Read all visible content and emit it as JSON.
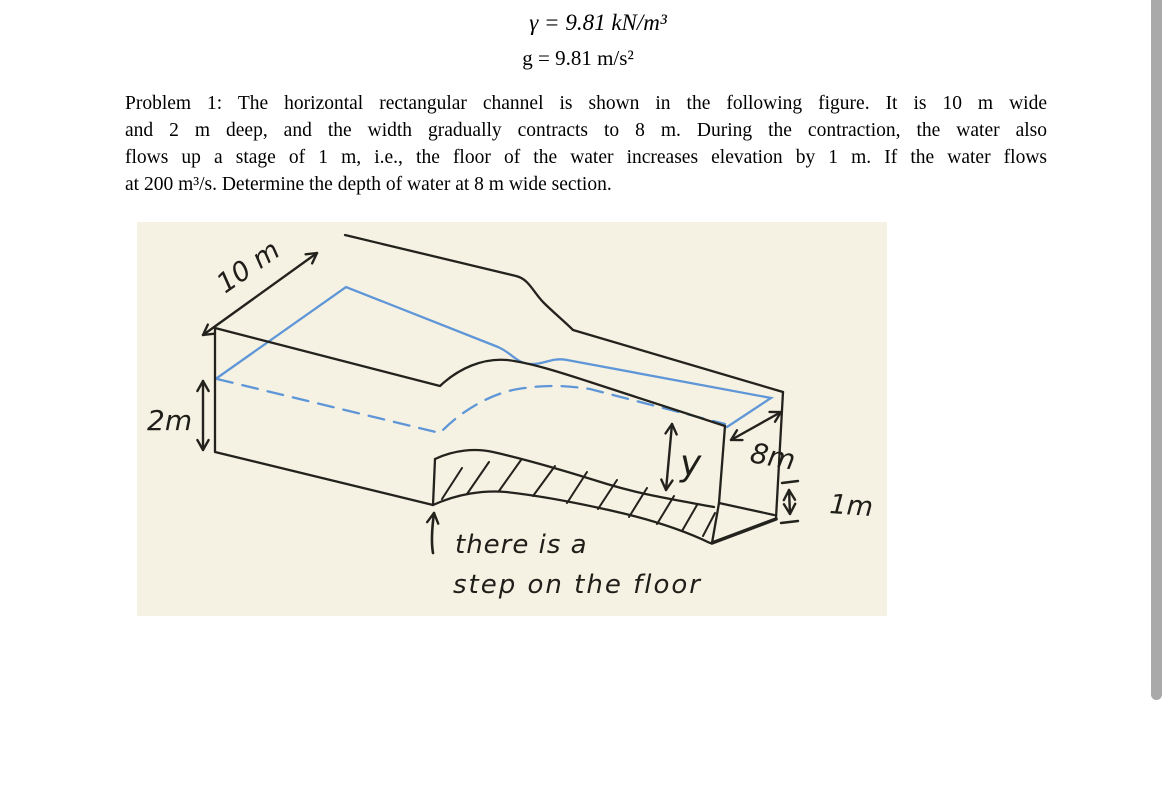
{
  "equations": {
    "line1": "γ = 9.81 kN/m³",
    "line2": "g = 9.81 m/s²"
  },
  "problem": {
    "lines": [
      "Problem 1: The horizontal rectangular channel is shown in the following figure. It is 10 m wide",
      "and 2 m deep, and the width gradually contracts to 8 m. During the contraction, the water also",
      "flows up a stage of 1 m, i.e., the floor of the water increases elevation by 1 m. If the water flows",
      "at 200 m³/s. Determine the depth of water at 8 m wide section."
    ]
  },
  "figure": {
    "labels": {
      "width_upstream": "10 m",
      "depth_upstream": "2m",
      "depth_downstream": "y",
      "width_downstream": "8m",
      "step_height": "1m",
      "note_line1": "there is a",
      "note_line2": "step on the floor"
    },
    "colors": {
      "background": "#f5f2e3",
      "ink": "#23221d",
      "water_blue": "#5f96d7"
    }
  },
  "scrollbar": {
    "thumb_color": "#a9a9a9"
  }
}
